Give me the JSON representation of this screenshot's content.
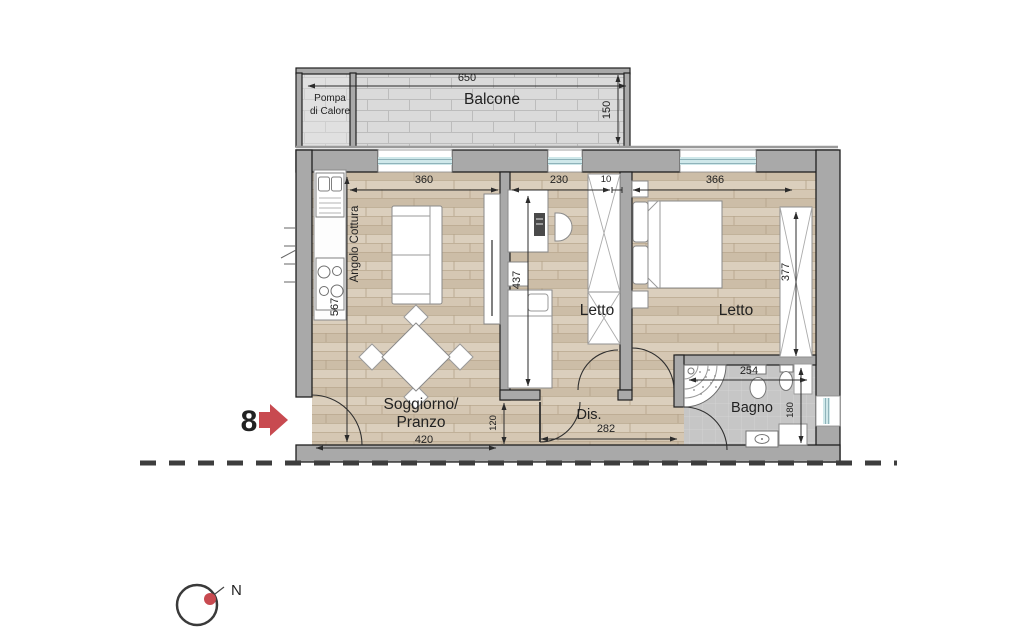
{
  "floorplan": {
    "unit_marker": "8",
    "compass": {
      "north": "N"
    },
    "labels": {
      "balcone": "Balcone",
      "pompa_line1": "Pompa",
      "pompa_line2": "di Calore",
      "angolo_cottura": "Angolo Cottura",
      "soggiorno_line1": "Soggiorno/",
      "soggiorno_line2": "Pranzo",
      "letto_centro": "Letto",
      "letto_destra": "Letto",
      "disimpegno": "Dis.",
      "bagno": "Bagno"
    },
    "dimensions_cm": {
      "balcone_larghezza": "650",
      "balcone_profondita": "150",
      "soggiorno_larghezza": "360",
      "letto_centro_larghezza": "230",
      "tramezzo": "10",
      "letto_destra_larghezza": "366",
      "soggiorno_altezza": "567",
      "letto_centro_altezza": "437",
      "armadio_altezza": "377",
      "passaggio": "120",
      "soggiorno_larghezza_basso": "420",
      "disimpegno_larghezza": "282",
      "bagno_larghezza": "254",
      "bagno_altezza": "180"
    },
    "colors": {
      "wall": "#a9a9a9",
      "floor_wood": "#d3c5b1",
      "balcony_tile": "#d9d9d9",
      "bath_floor": "#c6c6c6",
      "window_glass": "#cfe8ea",
      "accent_red": "#c84a50",
      "line_dark": "#2b2b2b"
    }
  }
}
